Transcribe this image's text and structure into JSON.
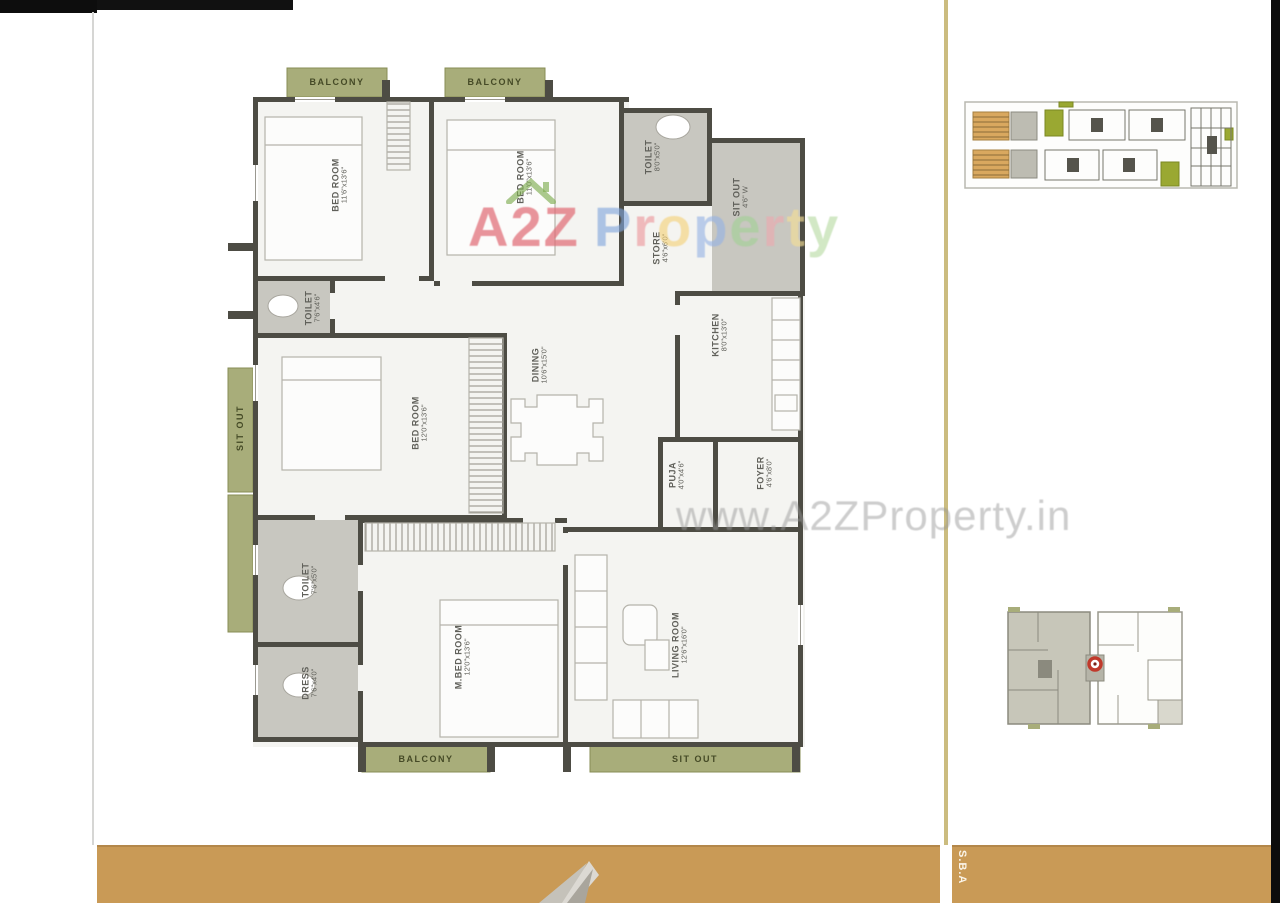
{
  "watermark": {
    "url": "www.A2ZProperty.in",
    "brand_letters": [
      {
        "ch": "A",
        "color": "rgba(224,108,118,0.72)"
      },
      {
        "ch": "2",
        "color": "rgba(224,108,118,0.72)"
      },
      {
        "ch": "Z",
        "color": "rgba(224,108,118,0.72)"
      },
      {
        "ch": "P",
        "color": "rgba(128,164,219,0.62)"
      },
      {
        "ch": "r",
        "color": "rgba(236,148,154,0.62)"
      },
      {
        "ch": "o",
        "color": "rgba(244,208,118,0.62)"
      },
      {
        "ch": "p",
        "color": "rgba(148,178,228,0.62)"
      },
      {
        "ch": "e",
        "color": "rgba(162,208,148,0.62)"
      },
      {
        "ch": "r",
        "color": "rgba(238,168,174,0.62)"
      },
      {
        "ch": "t",
        "color": "rgba(246,222,148,0.62)"
      },
      {
        "ch": "y",
        "color": "rgba(182,218,162,0.62)"
      }
    ],
    "house_icon_color": "#7fae52"
  },
  "floorplan": {
    "rooms": [
      {
        "name": "BED ROOM",
        "dims": "11'6\"x13'6\""
      },
      {
        "name": "BED ROOM",
        "dims": "11'0\"x13'6\""
      },
      {
        "name": "TOILET",
        "dims": "8'0\"x5'0\""
      },
      {
        "name": "SIT OUT",
        "dims": "4'6\" W"
      },
      {
        "name": "TOILET",
        "dims": "7'6\"x4'6\""
      },
      {
        "name": "BED ROOM",
        "dims": "12'0\"x13'6\""
      },
      {
        "name": "STORE",
        "dims": "4'6\"x6'0\""
      },
      {
        "name": "KITCHEN",
        "dims": "8'0\"x13'0\""
      },
      {
        "name": "PUJA",
        "dims": "4'0\"x4'6\""
      },
      {
        "name": "FOYER",
        "dims": "4'6\"x8'0\""
      },
      {
        "name": "TOILET",
        "dims": "7'6\"x5'0\""
      },
      {
        "name": "DRESS",
        "dims": "7'6\"x4'0\""
      },
      {
        "name": "M.BED ROOM",
        "dims": "12'0\"x13'6\""
      },
      {
        "name": "LIVING ROOM",
        "dims": "12'6\"x16'0\""
      },
      {
        "name": "DINING",
        "dims": "10'6\"x15'0\""
      }
    ],
    "balconies": [
      {
        "label": "BALCONY"
      },
      {
        "label": "BALCONY"
      },
      {
        "label": "SIT OUT"
      },
      {
        "label": "BALCONY"
      },
      {
        "label": "SIT OUT"
      }
    ]
  },
  "footer": {
    "side_text": "S.B.A"
  },
  "colors": {
    "footer_orange": "#c99a56",
    "wall": "#4d4c44",
    "balcony_green": "#a8ad7a",
    "toilet_gray": "#c8c7c0",
    "stair_orange": "#d9a85f",
    "lift_green": "#9aa832",
    "marker_red": "#c0392b"
  }
}
